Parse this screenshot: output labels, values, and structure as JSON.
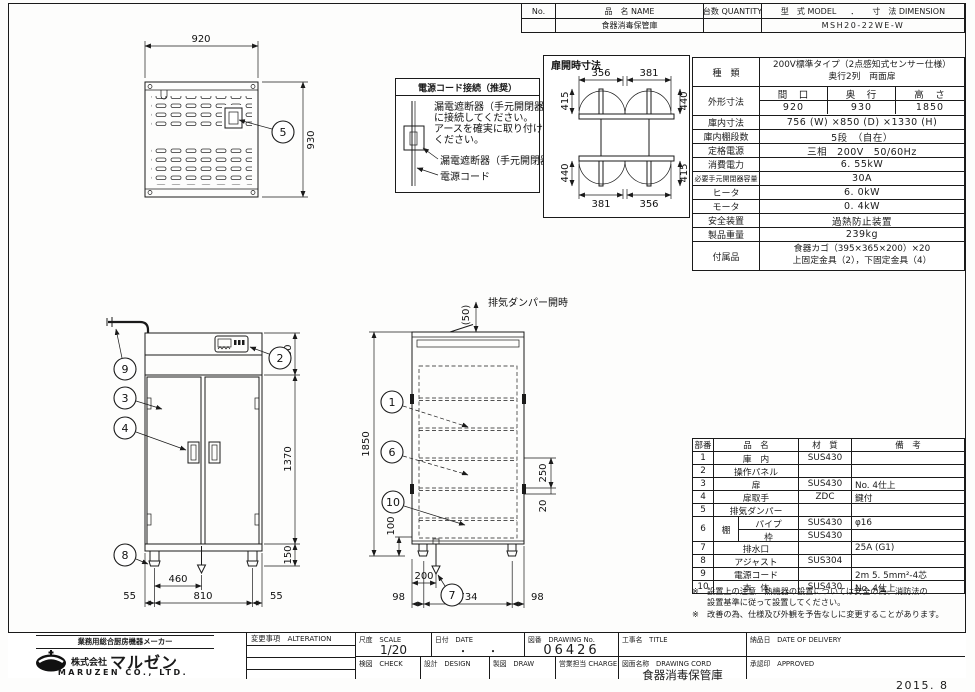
{
  "colors": {
    "ink": "#1a1a1a",
    "paper": "#fdfdfc"
  },
  "title_block": {
    "no_label": "No.",
    "name_label": "品　名 NAME",
    "qty_label": "台数 QUANTITY",
    "model_label": "型　式 MODEL",
    "dot": "．",
    "dim_label": "寸　法 DIMENSION",
    "name_value": "食器消毒保管庫",
    "model_value": "MSH20-22WE-W"
  },
  "spec": {
    "kind_label": "種　類",
    "kind1": "200V標準タイプ（2点感知式センサー仕様）",
    "kind2": "奥行2列　両面扉",
    "outer_label": "外形寸法",
    "outer_c1": "間　口",
    "outer_c2": "奥　行",
    "outer_c3": "高　さ",
    "outer_v1": "920",
    "outer_v2": "930",
    "outer_v3": "1850",
    "rows": [
      {
        "label": "庫内寸法",
        "value": "756 (W) ×850 (D) ×1330 (H)"
      },
      {
        "label": "庫内棚段数",
        "value": "5段　（自在）"
      },
      {
        "label": "定格電源",
        "value": "三相　200V　50/60Hz"
      },
      {
        "label": "消費電力",
        "value": "6. 55kW"
      },
      {
        "label": "必要手元開閉器容量",
        "value": "30A"
      },
      {
        "label": "ヒータ",
        "value": "6. 0kW"
      },
      {
        "label": "モータ",
        "value": "0. 4kW"
      },
      {
        "label": "安全装置",
        "value": "過熱防止装置"
      },
      {
        "label": "製品重量",
        "value": "239kg"
      }
    ],
    "acc_label": "付属品",
    "acc1": "食器カゴ（395×365×200）×20",
    "acc2": "上固定金具（2），下固定金具（4）"
  },
  "parts": {
    "h_no": "部番",
    "h_name": "品　名",
    "h_mat": "材　質",
    "h_note": "備　考",
    "rows_a": [
      {
        "no": "1",
        "name": "庫　内",
        "mat": "SUS430",
        "note": ""
      },
      {
        "no": "2",
        "name": "操作パネル",
        "mat": "",
        "note": ""
      },
      {
        "no": "3",
        "name": "扉",
        "mat": "SUS430",
        "note": "No. 4仕上"
      },
      {
        "no": "4",
        "name": "扉取手",
        "mat": "ZDC",
        "note": "鍵付"
      },
      {
        "no": "5",
        "name": "排気ダンパー",
        "mat": "",
        "note": ""
      }
    ],
    "row6": {
      "no": "6",
      "name": "棚",
      "sub1": {
        "name": "パイプ",
        "mat": "SUS430",
        "note": "φ16"
      },
      "sub2": {
        "name": "枠",
        "mat": "SUS430",
        "note": ""
      }
    },
    "rows_b": [
      {
        "no": "7",
        "name": "排水口",
        "mat": "",
        "note": "25A (G1)"
      },
      {
        "no": "8",
        "name": "アジャスト",
        "mat": "SUS304",
        "note": ""
      },
      {
        "no": "9",
        "name": "電源コード",
        "mat": "",
        "note": "2m 5. 5mm²-4芯"
      },
      {
        "no": "10",
        "name": "本　体",
        "mat": "SUS430",
        "note": "No. 4仕上"
      }
    ],
    "note1": "※　設置上の注意　熱機器の設置については安全の為、消防法の",
    "note2": "設置基準に従って設置してください。",
    "note3": "※　改善の為、仕様及び外観を予告なしに変更することがあります。"
  },
  "power_box": {
    "title": "電源コード接続（推奨）",
    "line1": "漏電遮断器（手元開閉器）",
    "line2": "に接続してください。",
    "line3": "アースを確実に取り付けて",
    "line4": "ください。",
    "label_breaker": "漏電遮断器（手元開閉器）",
    "label_cord": "電源コード"
  },
  "door_box": {
    "title": "扉開時寸法",
    "t_wl": "356",
    "t_wr": "381",
    "t_hl": "415",
    "t_hr": "440",
    "b_wl": "381",
    "b_wr": "356",
    "b_hl": "440",
    "b_hr": "415"
  },
  "top_view": {
    "w": "920",
    "d": "930",
    "c5": "5"
  },
  "front_view": {
    "d330": "330",
    "d1370": "1370",
    "d150": "150",
    "d460": "460",
    "d55l": "55",
    "d810": "810",
    "d55r": "55",
    "c9": "9",
    "c3": "3",
    "c4": "4",
    "c2": "2",
    "c8": "8"
  },
  "section_view": {
    "d1850": "1850",
    "d50": "(50)",
    "damper": "排気ダンパー開時",
    "d250": "250",
    "d20": "20",
    "d100": "100",
    "d200": "200",
    "d98l": "98",
    "d734": "734",
    "d98r": "98",
    "c1": "1",
    "c6": "6",
    "c10": "10",
    "c7": "7"
  },
  "footer": {
    "alteration": "変更事項　ALTERATION",
    "scale_label": "尺度　SCALE",
    "scale_value": "1/20",
    "date_label": "日付　DATE",
    "date_value": "・　　・",
    "dwgno_label": "図番　DRAWING No.",
    "dwgno_value": "06426",
    "title_label": "工事名　TITLE",
    "delivery_label": "納品日　DATE OF DELIVERY",
    "check_label": "検図　CHECK",
    "design_label": "設計　DESIGN",
    "draw_label": "製図　DRAW",
    "charge_label": "営業担当 CHARGE",
    "dwgname_label": "図面名称　DRAWING CORD",
    "dwgname_value": "食器消毒保管庫",
    "approved_label": "承認印　APPROVED",
    "issued": "2015. 8"
  },
  "company": {
    "tagline": "業務用総合厨房機器メーカー",
    "prefix": "株式会社",
    "name": "マルゼン",
    "en": "MARUZEN  CO., LTD."
  }
}
